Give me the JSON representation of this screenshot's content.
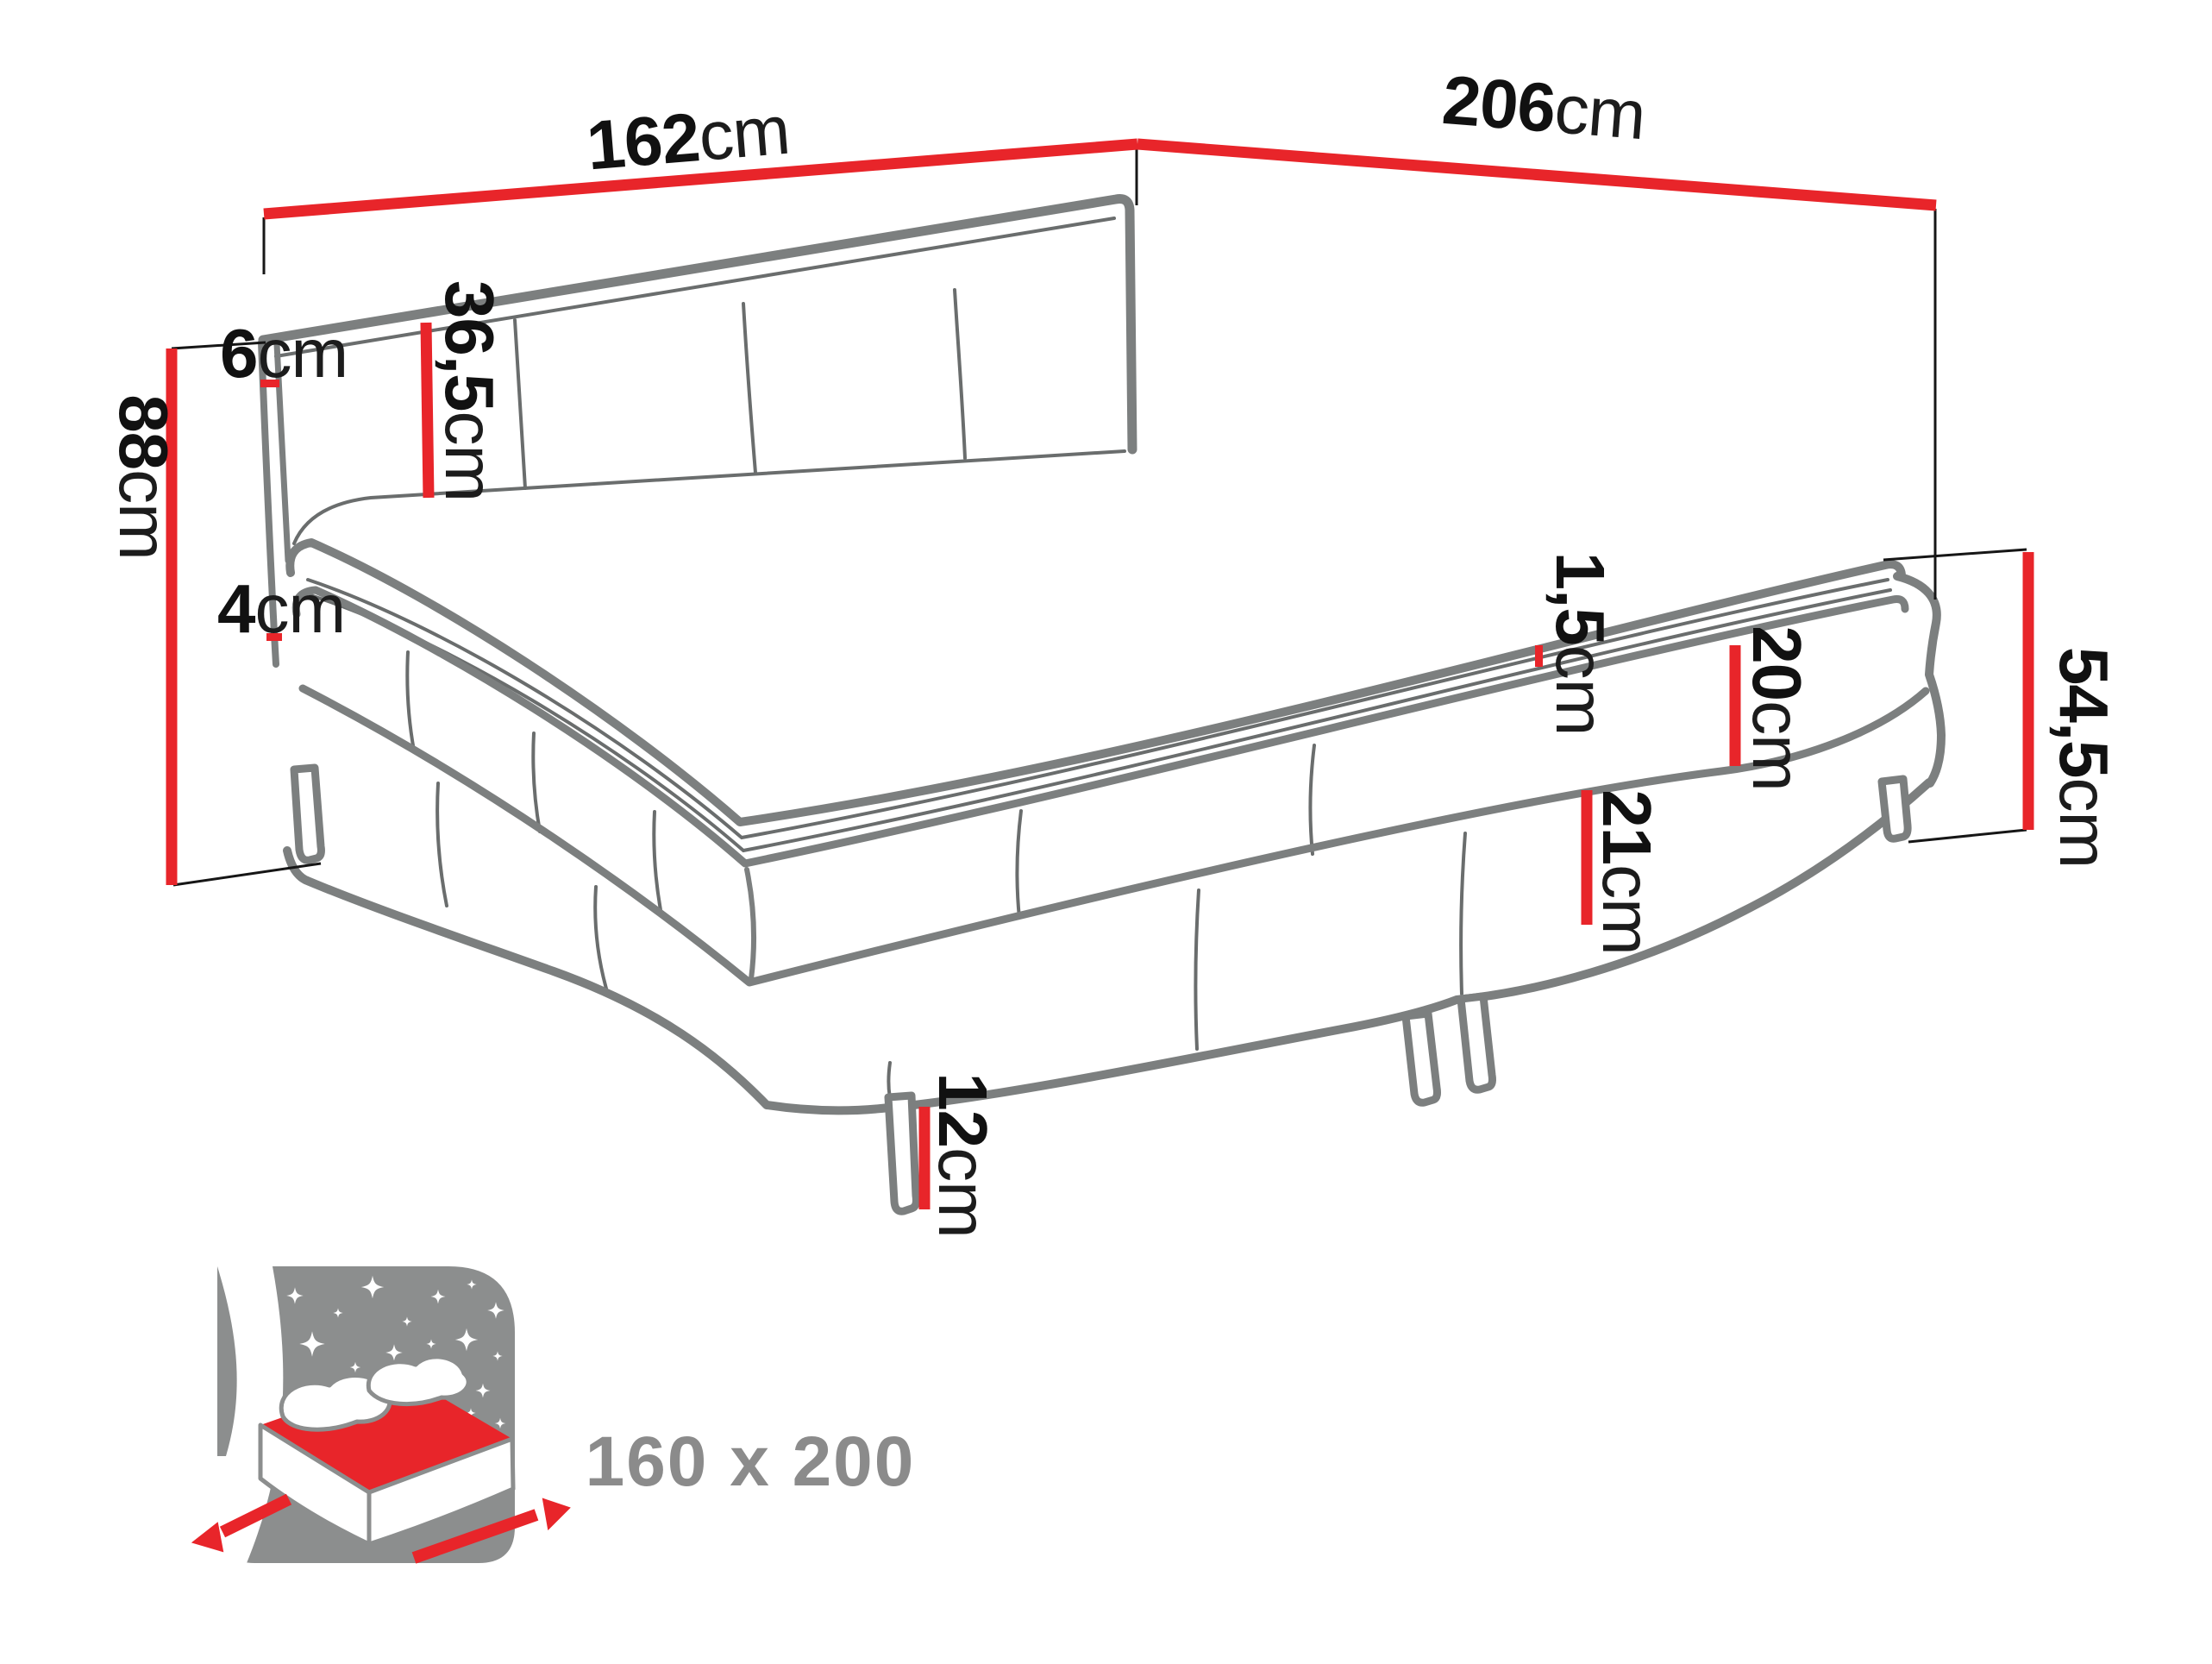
{
  "diagram": {
    "type": "furniture-dimension-diagram",
    "product": "boxspring-bed",
    "size_label": "160 x 200",
    "dimensions": {
      "width_top": {
        "value": "162",
        "unit": "cm"
      },
      "length_top": {
        "value": "206",
        "unit": "cm"
      },
      "height_total": {
        "value": "88",
        "unit": "cm"
      },
      "headboard_height": {
        "value": "36,5",
        "unit": "cm"
      },
      "headboard_depth": {
        "value": "6",
        "unit": "cm"
      },
      "topper_height": {
        "value": "4",
        "unit": "cm"
      },
      "rim_height": {
        "value": "1,5",
        "unit": "cm"
      },
      "mattress_height": {
        "value": "20",
        "unit": "cm"
      },
      "base_height": {
        "value": "21",
        "unit": "cm"
      },
      "side_height": {
        "value": "54,5",
        "unit": "cm"
      },
      "leg_height": {
        "value": "12",
        "unit": "cm"
      }
    },
    "colors": {
      "accent": "#e8252a",
      "line_gray": "#7c7f7f",
      "text": "#111111",
      "icon_gray": "#8c8e8e",
      "size_label_gray": "#8b8b8b"
    }
  }
}
